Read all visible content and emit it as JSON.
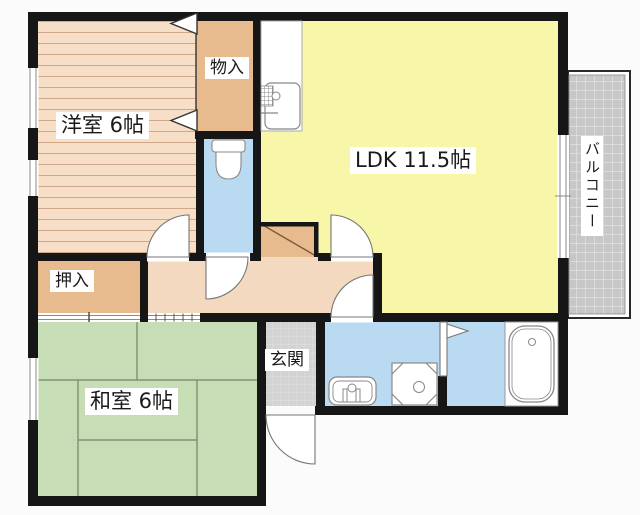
{
  "floorplan": {
    "type": "apartment-floor-plan",
    "rooms": [
      {
        "id": "western-room",
        "label": "洋室 6帖"
      },
      {
        "id": "storage-monoire",
        "label": "物入"
      },
      {
        "id": "ldk",
        "label": "LDK 11.5帖"
      },
      {
        "id": "balcony",
        "label": "バルコニー"
      },
      {
        "id": "closet-oshiire",
        "label": "押入"
      },
      {
        "id": "japanese-room",
        "label": "和室 6帖"
      },
      {
        "id": "entrance",
        "label": "玄関"
      }
    ],
    "fixtures": [
      "kitchen-sink-icon",
      "toilet-icon",
      "washbasin-icon",
      "washing-machine-pan-icon",
      "bathtub-icon",
      "shoe-cabinet-icon",
      "folding-bath-door-icon"
    ],
    "colors": {
      "wall": "#161616",
      "ldk": "#f8f6a9",
      "tatami": "#c6ddb5",
      "wood_floor": "#f6dfc6",
      "closet": "#e7bb8d",
      "hallway": "#f3d9c0",
      "water_rooms": "#badaf1",
      "entrance_tile": "#d3d3d3",
      "balcony_tile": "#c7c7c7",
      "label_bg": "#ffffff"
    }
  }
}
